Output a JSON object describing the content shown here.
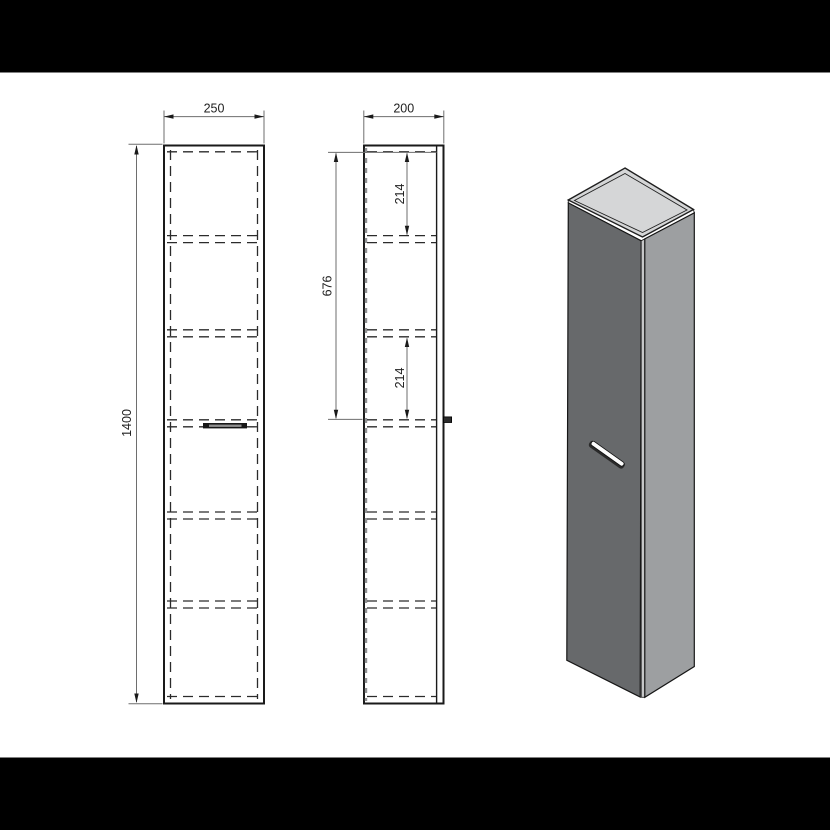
{
  "page": {
    "background_color": "#ffffff",
    "letterbox_color": "#000000"
  },
  "drawing": {
    "front_view": {
      "width_dim": "250",
      "height_dim": "1400"
    },
    "side_view": {
      "depth_dim": "200",
      "top_compartment_dim": "214",
      "upper_section_dim": "676",
      "middle_compartment_dim": "214"
    },
    "line_colors": {
      "outline": "#1a1a1a",
      "hidden_dash": "#2b2b2b",
      "dimension": "#6e6e6e",
      "extension": "#8f9092",
      "text": "#1f1f1f"
    }
  },
  "render_3d": {
    "top_face_color": "#d5d6d7",
    "lid_rim_color": "#eeeeef",
    "door_face_color": "#67696b",
    "front_edge_color": "#c6c7c8",
    "side_face_color": "#9d9fa1",
    "handle_top_color": "#fdfdfd",
    "handle_shadow_color": "#2a2a2a"
  }
}
